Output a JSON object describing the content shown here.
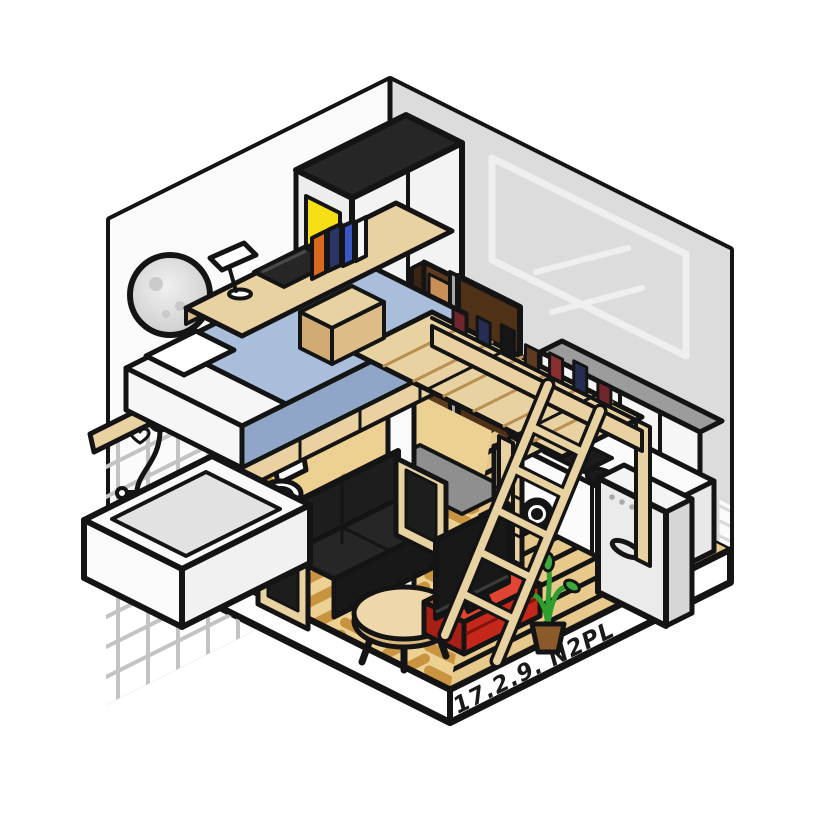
{
  "signature": {
    "text": "17.2.9. N2PL"
  },
  "palette": {
    "outline": "#141414",
    "paper": "#ffffff",
    "wall_left": "#fbfbfb",
    "wall_right": "#dcdcdc",
    "moon_light": "#f0f0f0",
    "moon_dark": "#c9c9c9",
    "crater": "#bdbdbd",
    "picture_line": "#efefef",
    "tile_line_bath": "#c3c3c3",
    "tile_bg_kitchen": "#fafafa",
    "tile_line_kitchen": "#d8d8d8",
    "wardrobe_top": "#262626",
    "wardrobe_white": "#f3f3f3",
    "wardrobe_side": "#ededed",
    "poster_yellow": "#f6df17",
    "door_brown": "#4f3118",
    "door_frame": "#a8a8a8",
    "door_knob": "#c0c0c0",
    "closet_brown": "#5d3a20",
    "closet_dark": "#3a2412",
    "closet_shelf": "#c89058",
    "cabinet_front": "#f6f6f6",
    "cabinet_top": "#9c9c9c",
    "counter_white": "#fbfbfb",
    "counter_side": "#e8e8e8",
    "cooktop_black": "#1b1b1b",
    "sink_black": "#1a1a1a",
    "washer_black": "#151515",
    "fridge_front": "#ebebeb",
    "fridge_top": "#f4f4f4",
    "fridge_side": "#d6d6d6",
    "fridge_dot": "#a9a9a9",
    "cooker_red": "#e23a28",
    "cooker_lid": "#ef5242",
    "bottle_navy": "#2e3270",
    "wood": "#e9d2a2",
    "wood_mid": "#ddbc87",
    "wood_mid2": "#d2ab74",
    "platform_wood": "#ead1a2",
    "slat_line": "#b98f52",
    "floor_bg": "#ecd193",
    "plank": "#c8943f",
    "stripe_bg": "#e8c98c",
    "genkan_gray": "#8f8f8f",
    "porcelain": "#ffffff",
    "tub_white": "#fafafa",
    "tub_white2": "#f1f1f1",
    "tub_inner": "#e2e2e2",
    "bed_white": "#f6f6f6",
    "blanket_top": "#a9bedb",
    "blanket_side": "#8fa6c8",
    "sofa_black": "#1d1d1d",
    "sofa_seat": "#262626",
    "sofa_front": "#181818",
    "table_top": "#eed7aa",
    "table_edge": "#d9b87e",
    "stand_red": "#e04432",
    "stand_red_front": "#c5271b",
    "stand_red_side": "#a81f15",
    "stand_seam": "#7c150d",
    "tv_black": "#181818",
    "tv_screen_line": "#3a3a3a",
    "laptop_black": "#262626",
    "plant_green": "#3cab3c",
    "plant_stem": "#2f9e2f",
    "pot_brown": "#8a5a2b",
    "desk_book_orange": "#d96a1f",
    "desk_book_navy": "#2b3668",
    "desk_book_blue": "#3a57c4",
    "desk_book_white": "#f5f5f5",
    "rail_book_a": "#70252d",
    "rail_book_b": "#262d52",
    "rail_book_c": "#161616",
    "rail_book_d": "#5d3a20",
    "rail_book_e": "#8a2f2f",
    "signature_ink": "#1a1a1a"
  }
}
